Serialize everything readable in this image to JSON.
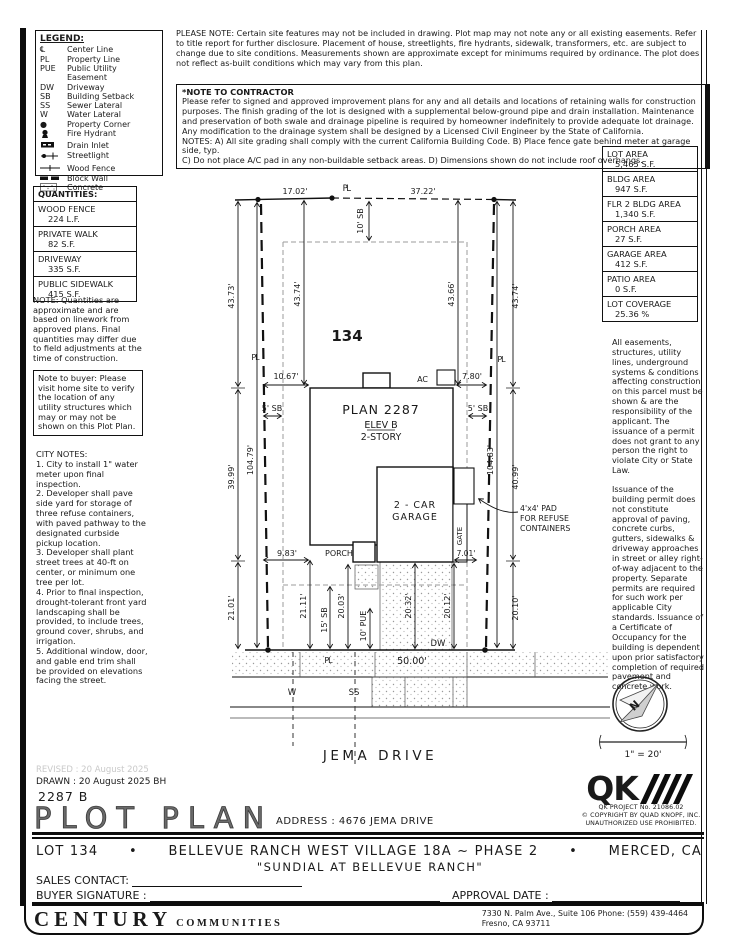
{
  "notes": {
    "please_note": "PLEASE NOTE:  Certain site features may not be included in drawing. Plot map may not note any or all existing easements. Refer to title report for further disclosure. Placement of house, streetlights, fire hydrants, sidewalk, transformers, etc. are subject to change due to site conditions. Measurements shown are approximate except for minimums required by ordinance. The plot does not reflect as-built conditions which may vary from this plan.",
    "contractor_title": "*NOTE TO CONTRACTOR",
    "contractor_body": "Please refer to signed and approved improvement plans for any and all details and locations of retaining walls for construction purposes. The finish grading of the lot is designed with a supplemental below-ground pipe and drain installation. Maintenance and preservation of both swale and drainage pipeline is required by homeowner indefinitely to provide adequate lot drainage. Any modification to the drainage system shall be designed by a Licensed Civil Engineer by the State of California.\nNOTES:  A) All site grading shall comply with the current California Building Code.  B) Place fence gate behind meter at garage side, typ.\nC) Do not place A/C pad in any non-buildable setback areas.  D) Dimensions shown do not include roof overhangs."
  },
  "legend": {
    "title": "LEGEND:",
    "items": [
      {
        "symbol": "℄",
        "label": "Center Line"
      },
      {
        "symbol": "PL",
        "label": "Property Line"
      },
      {
        "symbol": "PUE",
        "label": "Public Utility Easement"
      },
      {
        "symbol": "DW",
        "label": "Driveway"
      },
      {
        "symbol": "SB",
        "label": "Building Setback"
      },
      {
        "symbol": "SS",
        "label": "Sewer Lateral"
      },
      {
        "symbol": "W",
        "label": "Water Lateral"
      },
      {
        "symbol": "●",
        "label": "Property Corner"
      },
      {
        "symbol": "",
        "label": "Fire Hydrant"
      },
      {
        "symbol": "",
        "label": "Drain Inlet"
      },
      {
        "symbol": "",
        "label": "Streetlight"
      },
      {
        "symbol": "",
        "label": "Wood Fence"
      },
      {
        "symbol": "",
        "label": "Block Wall"
      },
      {
        "symbol": "",
        "label": "Concrete"
      }
    ]
  },
  "quantities": {
    "title": "QUANTITIES:",
    "rows": [
      {
        "name": "WOOD FENCE",
        "value": "224 L.F."
      },
      {
        "name": "PRIVATE WALK",
        "value": "82 S.F."
      },
      {
        "name": "DRIVEWAY",
        "value": "335 S.F."
      },
      {
        "name": "PUBLIC SIDEWALK",
        "value": "415 S.F."
      }
    ],
    "note": "NOTE: Quantities are approximate and are based on linework from approved plans.  Final quantities may differ due to field adjustments at the time of construction.",
    "buyer_note": "Note to buyer: Please visit home site to verify the location of any utility structures which may or may not be shown on this Plot Plan."
  },
  "city_notes": {
    "title": "CITY NOTES:",
    "body": "1. City to install 1\" water meter upon final inspection.\n2. Developer shall pave side yard for storage of three refuse containers, with paved pathway to the designated curbside pickup location.\n3. Developer shall plant street trees at 40-ft on center, or minimum one tree per lot.\n4. Prior to final inspection, drought-tolerant front yard landscaping shall be provided, to include trees, ground cover, shrubs, and irrigation.\n5. Additional window, door, and gable end trim shall be provided on elevations facing the street."
  },
  "areas": {
    "rows": [
      {
        "name": "LOT AREA",
        "value": "5,465 S.F."
      },
      {
        "name": "BLDG AREA",
        "value": "947 S.F."
      },
      {
        "name": "FLR 2 BLDG AREA",
        "value": "1,340 S.F."
      },
      {
        "name": "PORCH AREA",
        "value": "27 S.F."
      },
      {
        "name": "GARAGE AREA",
        "value": "412 S.F."
      },
      {
        "name": "PATIO AREA",
        "value": "0 S.F."
      },
      {
        "name": "LOT COVERAGE",
        "value": "25.36 %"
      }
    ]
  },
  "side_notes": {
    "easements": "All easements, structures, utility lines, underground systems & conditions affecting construction on this parcel must be shown & are the responsibility of the applicant. The issuance of a permit does not grant to any person the right to violate City or State Law.",
    "permits": "Issuance of the building permit does not constitute approval of paving, concrete curbs, gutters, sidewalks & driveway approaches in street or alley right-of-way adjacent to the property. Separate permits are required for such work per applicable City standards. Issuance of a Certificate of Occupancy for the building is dependent upon prior satisfactory completion of required pavement and concrete work."
  },
  "plan": {
    "lot_number": "134",
    "name": "PLAN 2287",
    "elev": "ELEV B",
    "story": "2-STORY",
    "garage1": "2 - CAR",
    "garage2": "GARAGE",
    "porch": "PORCH",
    "gate": "GATE",
    "ac": "AC",
    "dw": "DW",
    "w": "W",
    "ss": "SS",
    "pl": "PL",
    "street": "JEMA DRIVE",
    "scale": "1\" = 20'",
    "north": "N",
    "refuse_lines": [
      "4'x4' PAD",
      "FOR REFUSE",
      "CONTAINERS"
    ],
    "dims": {
      "top_left": "17.02'",
      "top_right": "37.22'",
      "front_sb": "10' SB",
      "left_outer_top": "43.73'",
      "left_inner_top": "43.74'",
      "right_inner_top": "43.66'",
      "right_outer_top": "43.74'",
      "left_gap": "10.67'",
      "right_gap": "7.80'",
      "side_sb": "5' SB",
      "left_outer_mid": "39.99'",
      "left_inner_full": "104.79'",
      "right_inner_full": "104.83'",
      "right_outer_mid": "40.99'",
      "rear_left_width": "9.83'",
      "gate_width": "7.01'",
      "left_outer_bot": "21.01'",
      "left_rear": "21.11'",
      "rear_sb": "15' SB",
      "walk_depth": "20.03'",
      "pue": "10' PUE",
      "drive_a": "20.32'",
      "drive_b": "20.12'",
      "right_outer_bot": "20.10'",
      "frontage": "50.00'"
    }
  },
  "titleblock": {
    "revised": "REVISED :  20 August 2025",
    "drawn": "DRAWN :  20 August 2025  BH",
    "plan_number": "2287 B",
    "title": "PLOT PLAN",
    "address_label": "ADDRESS :  4676 JEMA DRIVE",
    "lot": "LOT 134",
    "bullet": "•",
    "community": "BELLEVUE RANCH WEST VILLAGE 18A ~ PHASE 2",
    "city": "MERCED, CA",
    "subtitle": "\"SUNDIAL AT BELLEVUE RANCH\"",
    "sales_contact_label": "SALES CONTACT:",
    "buyer_signature_label": "BUYER SIGNATURE :",
    "approval_date_label": "APPROVAL DATE :",
    "builder_name": "CENTURY",
    "builder_sub": "COMMUNITIES",
    "builder_address1": "7330 N. Palm Ave., Suite 106    Phone:  (559) 439-4464",
    "builder_address2": "Fresno, CA  93711",
    "qk_logo": "QK",
    "qk_project": "QK PROJECT No. 21086.02",
    "qk_copyright": "© COPYRIGHT BY QUAD KNOPF, INC.",
    "qk_use": "UNAUTHORIZED USE PROHIBITED."
  }
}
